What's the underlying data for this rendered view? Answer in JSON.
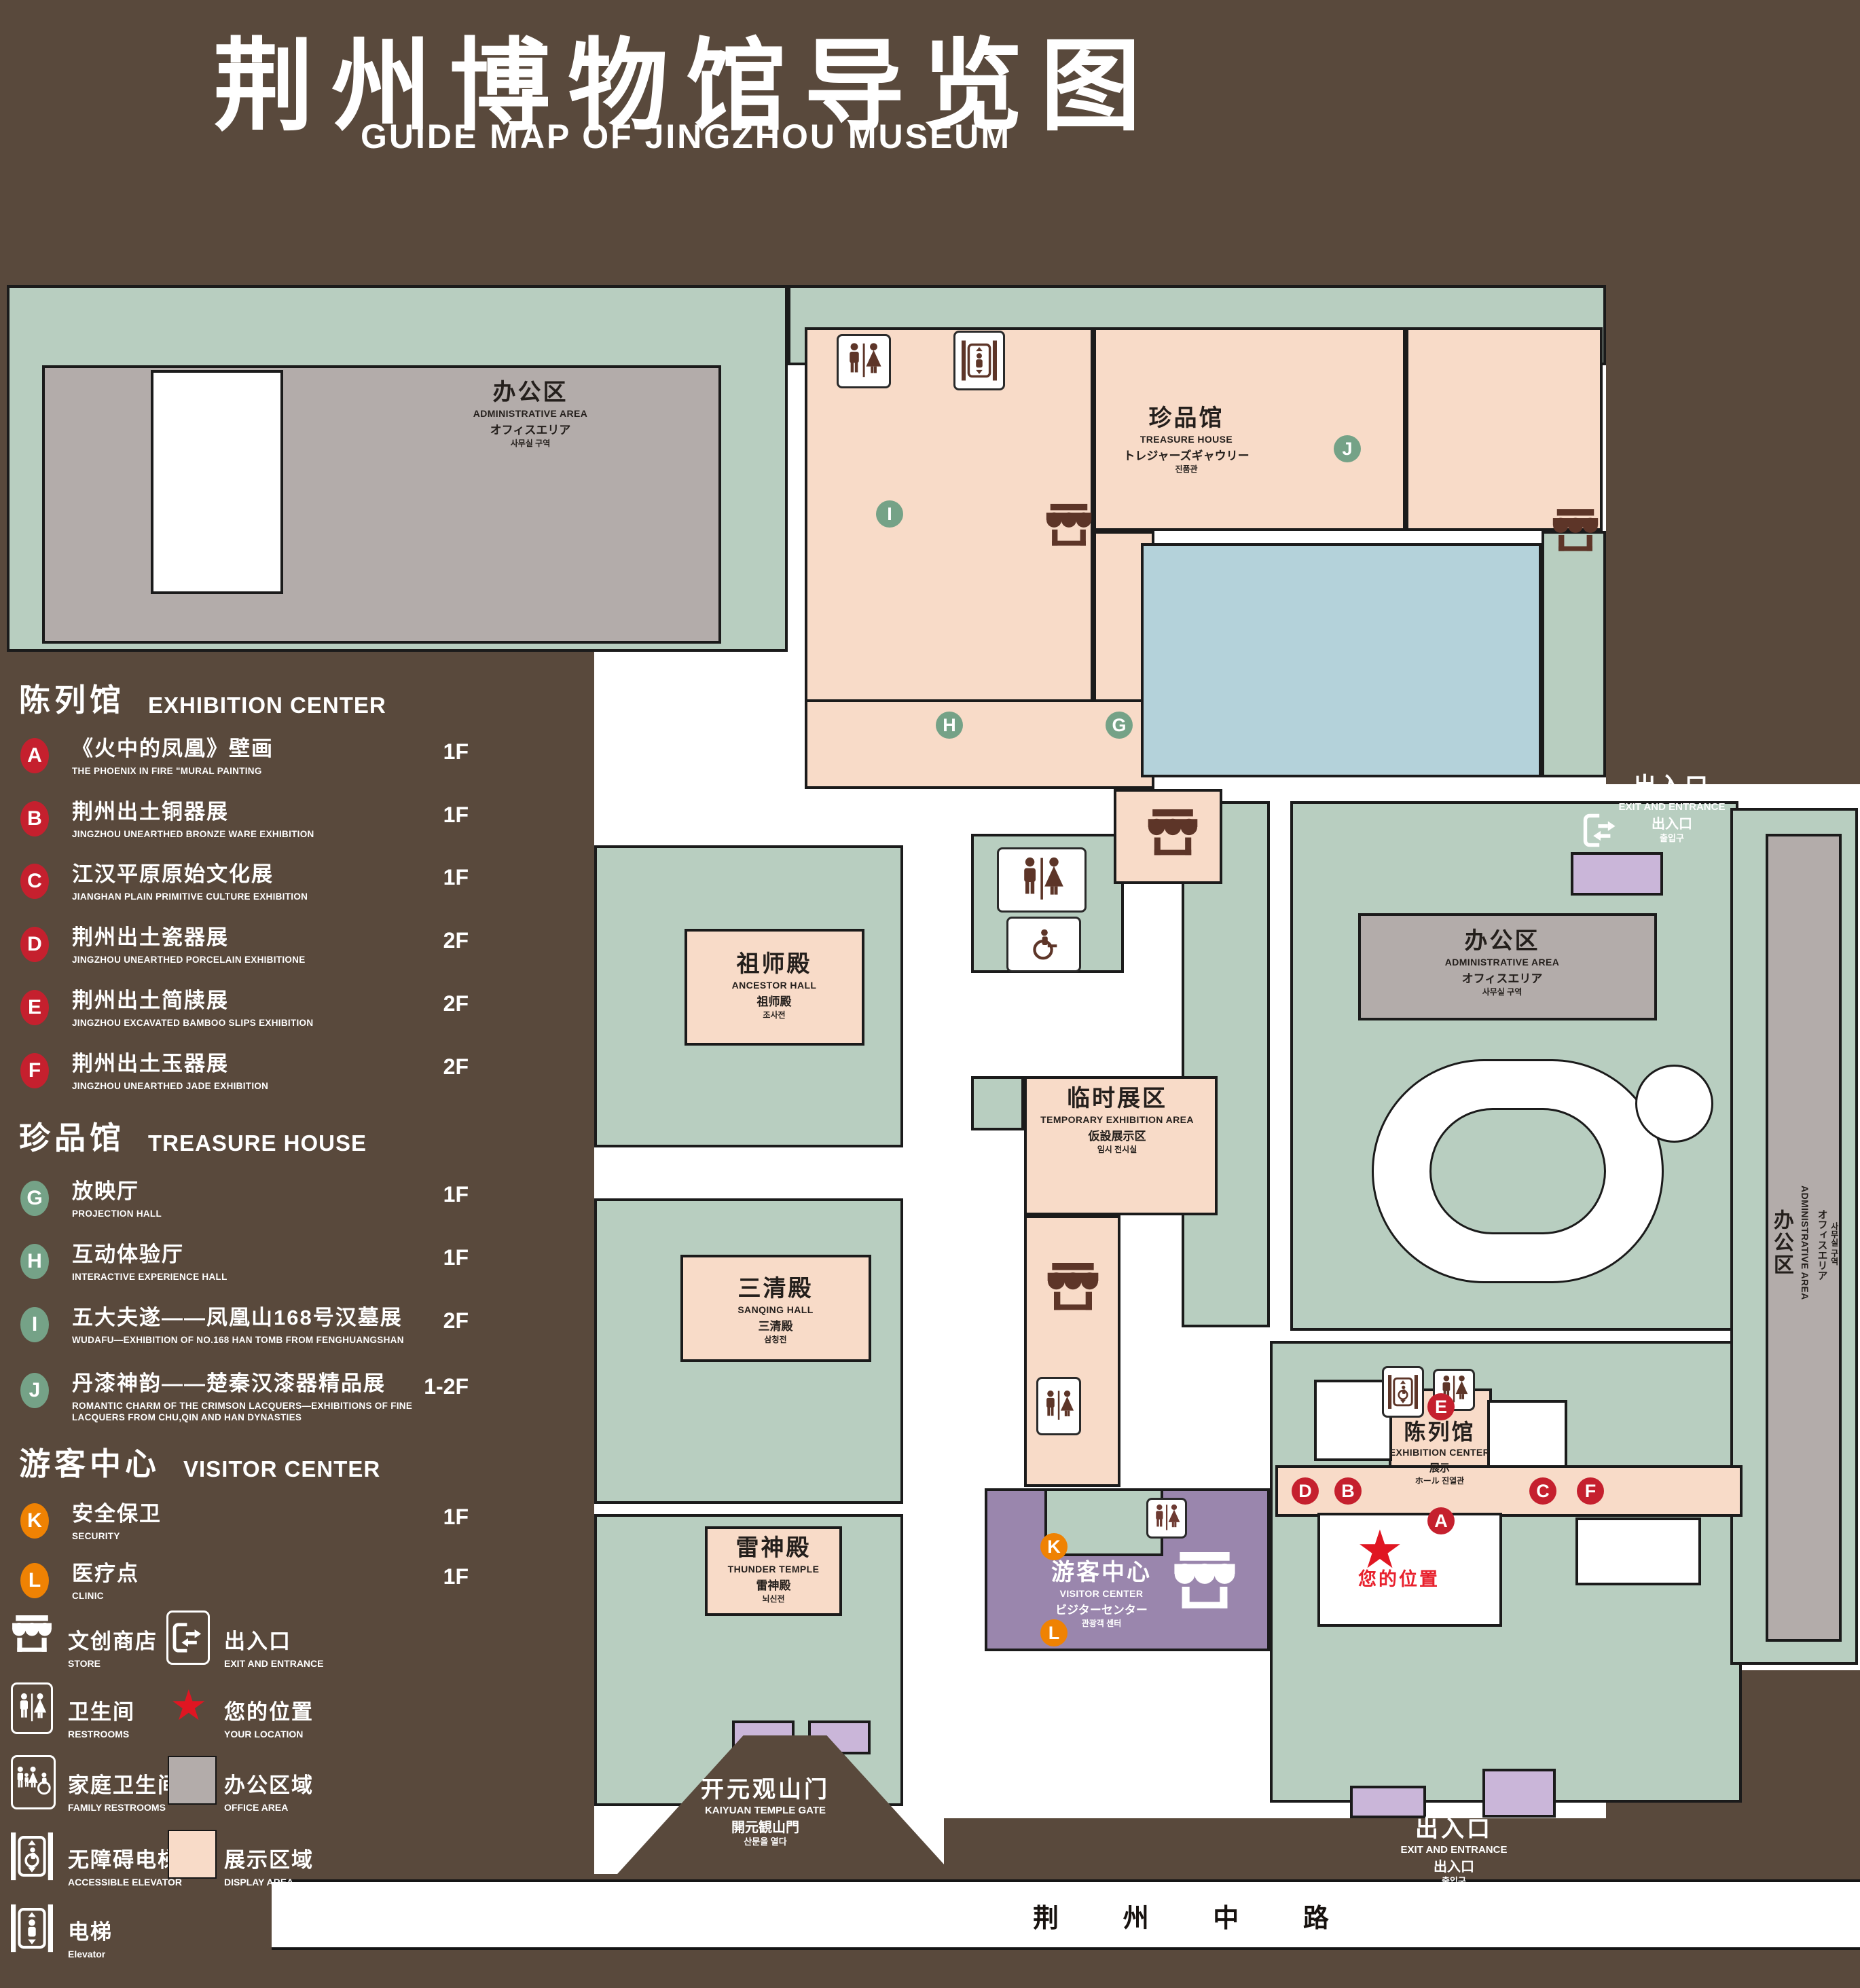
{
  "title": {
    "zh": "荆州博物馆导览图",
    "en": "GUIDE MAP OF JINGZHOU MUSEUM"
  },
  "colors": {
    "background_brown": "#59493c",
    "area_green": "#b8cec0",
    "area_pink_display": "#f8dbc8",
    "area_gray_office": "#b3acaa",
    "pond_blue": "#b4d2da",
    "visitor_purple": "#9a86ad",
    "entrance_light_purple": "#cab6d9",
    "badge_red": "#c5202e",
    "badge_green": "#75a287",
    "badge_orange": "#ef8203",
    "location_red": "#e01622"
  },
  "legend": {
    "sections": [
      {
        "title_zh": "陈列馆",
        "title_en": "EXHIBITION CENTER",
        "items": [
          {
            "letter": "A",
            "zh": "《火中的凤凰》壁画",
            "en": "THE PHOENIX IN FIRE \"MURAL PAINTING",
            "floor": "1F"
          },
          {
            "letter": "B",
            "zh": "荆州出土铜器展",
            "en": "JINGZHOU UNEARTHED BRONZE WARE EXHIBITION",
            "floor": "1F"
          },
          {
            "letter": "C",
            "zh": "江汉平原原始文化展",
            "en": "JIANGHAN PLAIN PRIMITIVE CULTURE EXHIBITION",
            "floor": "1F"
          },
          {
            "letter": "D",
            "zh": "荆州出土瓷器展",
            "en": "JINGZHOU UNEARTHED PORCELAIN EXHIBITIONE",
            "floor": "2F"
          },
          {
            "letter": "E",
            "zh": "荆州出土简牍展",
            "en": "JINGZHOU EXCAVATED BAMBOO SLIPS EXHIBITION",
            "floor": "2F"
          },
          {
            "letter": "F",
            "zh": "荆州出土玉器展",
            "en": "JINGZHOU UNEARTHED JADE EXHIBITION",
            "floor": "2F"
          }
        ]
      },
      {
        "title_zh": "珍品馆",
        "title_en": "TREASURE HOUSE",
        "items": [
          {
            "letter": "G",
            "zh": "放映厅",
            "en": "PROJECTION HALL",
            "floor": "1F"
          },
          {
            "letter": "H",
            "zh": "互动体验厅",
            "en": "INTERACTIVE EXPERIENCE HALL",
            "floor": "1F"
          },
          {
            "letter": "I",
            "zh": "五大夫遂——凤凰山168号汉墓展",
            "en": "WUDAFU—EXHIBITION OF NO.168 HAN TOMB FROM FENGHUANGSHAN",
            "floor": "2F"
          },
          {
            "letter": "J",
            "zh": "丹漆神韵——楚秦汉漆器精品展",
            "en": "ROMANTIC CHARM OF THE CRIMSON LACQUERS—EXHIBITIONS OF FINE LACQUERS FROM CHU,QIN AND HAN DYNASTIES",
            "floor": "1-2F"
          }
        ]
      },
      {
        "title_zh": "游客中心",
        "title_en": "VISITOR CENTER",
        "items": [
          {
            "letter": "K",
            "zh": "安全保卫",
            "en": "SECURITY",
            "floor": "1F"
          },
          {
            "letter": "L",
            "zh": "医疗点",
            "en": "CLINIC",
            "floor": "1F"
          }
        ]
      }
    ],
    "symbols": [
      {
        "icon": "store-icon",
        "zh": "文创商店",
        "en": "STORE"
      },
      {
        "icon": "exit-entrance-icon",
        "zh": "出入口",
        "en": "EXIT AND ENTRANCE"
      },
      {
        "icon": "restrooms-icon",
        "zh": "卫生间",
        "en": "RESTROOMS"
      },
      {
        "icon": "your-location-star",
        "zh": "您的位置",
        "en": "YOUR LOCATION"
      },
      {
        "icon": "family-restrooms-icon",
        "zh": "家庭卫生间",
        "en": "FAMILY RESTROOMS"
      },
      {
        "icon": "office-area-swatch",
        "zh": "办公区域",
        "en": "OFFICE AREA"
      },
      {
        "icon": "accessible-elevator-icon",
        "zh": "无障碍电梯",
        "en": "ACCESSIBLE ELEVATOR"
      },
      {
        "icon": "display-area-swatch",
        "zh": "展示区域",
        "en": "DISPLAY AREA"
      },
      {
        "icon": "elevator-icon",
        "zh": "电梯",
        "en": "Elevator"
      }
    ]
  },
  "map": {
    "areas": {
      "admin": {
        "l1": "办公区",
        "l2": "ADMINISTRATIVE AREA",
        "l3": "オフィスエリア",
        "l4": "사무실 구역"
      },
      "treasure": {
        "l1": "珍品馆",
        "l2": "TREASURE HOUSE",
        "l3": "トレジャーズギャウリー",
        "l4": "진품관"
      },
      "ancestor": {
        "l1": "祖师殿",
        "l2": "ANCESTOR HALL",
        "l3": "祖师殿",
        "l4": "조사전"
      },
      "temporary": {
        "l1": "临时展区",
        "l2": "TEMPORARY EXHIBITION AREA",
        "l3": "仮設展示区",
        "l4": "임시 전시실"
      },
      "sanqing": {
        "l1": "三清殿",
        "l2": "SANQING HALL",
        "l3": "三清殿",
        "l4": "삼청전"
      },
      "thunder": {
        "l1": "雷神殿",
        "l2": "THUNDER TEMPLE",
        "l3": "雷神殿",
        "l4": "뇌신전"
      },
      "visitor": {
        "l1": "游客中心",
        "l2": "VISITOR CENTER",
        "l3": "ビジターセンター",
        "l4": "관광객 센터"
      },
      "exhibition": {
        "l1": "陈列馆",
        "l2": "EXHIBITION CENTER",
        "l3": "展示",
        "l4": "ホール 진열관"
      },
      "gate": {
        "l1": "开元观山门",
        "l2": "KAIYUAN TEMPLE GATE",
        "l3": "開元観山門",
        "l4": "산문을 열다"
      },
      "exit": {
        "l1": "出入口",
        "l2": "EXIT AND ENTRANCE",
        "l3": "出入口",
        "l4": "출입구"
      },
      "road": {
        "l1": "荆 州 中 路"
      },
      "your_location": {
        "l1": "您的位置"
      }
    }
  }
}
